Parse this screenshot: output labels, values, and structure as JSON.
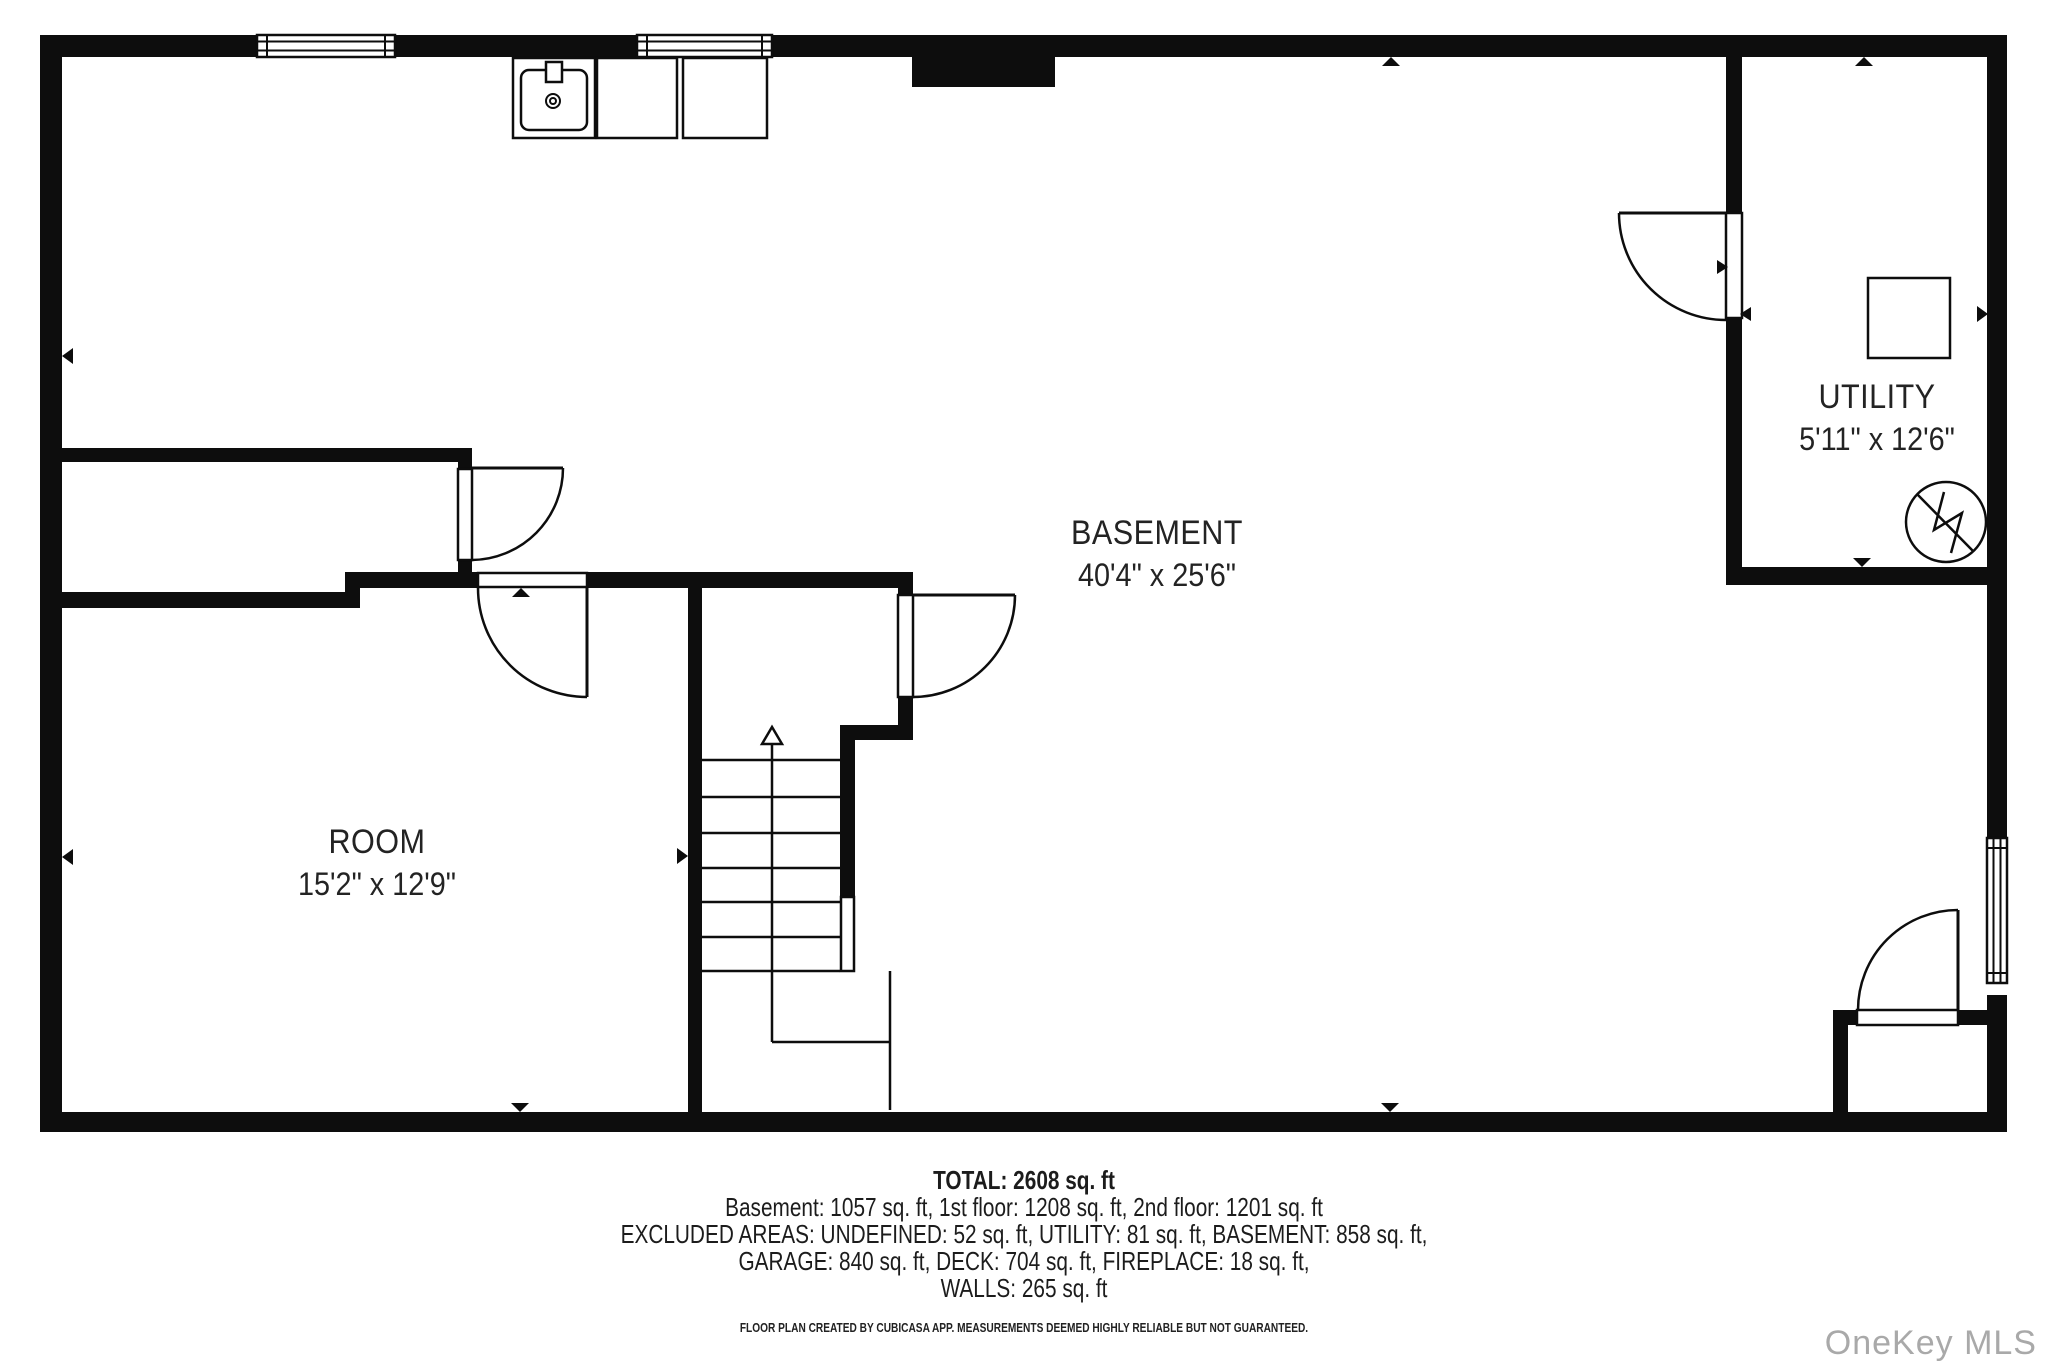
{
  "watermark": "OneKey MLS",
  "rooms": [
    {
      "name": "BASEMENT",
      "dims": "40'4\" x 25'6\"",
      "cx": 1157,
      "cy": 533
    },
    {
      "name": "UTILITY",
      "dims": "5'11\" x 12'6\"",
      "cx": 1877,
      "cy": 397
    },
    {
      "name": "ROOM",
      "dims": "15'2\" x 12'9\"",
      "cx": 377,
      "cy": 842
    }
  ],
  "footer": {
    "total": "TOTAL: 2608 sq. ft",
    "line1": "Basement: 1057 sq. ft, 1st floor: 1208 sq. ft, 2nd floor: 1201 sq. ft",
    "line2": "EXCLUDED AREAS: UNDEFINED: 52 sq. ft, UTILITY: 81 sq. ft, BASEMENT: 858 sq. ft,",
    "line3": "GARAGE: 840 sq. ft, DECK: 704 sq. ft, FIREPLACE: 18 sq. ft,",
    "line4": "WALLS: 265 sq. ft",
    "disclaimer": "FLOOR PLAN CREATED BY CUBICASA APP. MEASUREMENTS DEEMED HIGHLY RELIABLE BUT NOT GUARANTEED."
  },
  "plan": {
    "ink": "#0d0d0d",
    "walls": [
      [
        40,
        35,
        1967,
        22
      ],
      [
        40,
        35,
        22,
        1097
      ],
      [
        40,
        1112,
        1967,
        20
      ],
      [
        1987,
        35,
        20,
        803
      ],
      [
        1987,
        995,
        20,
        137
      ],
      [
        912,
        57,
        143,
        30
      ],
      [
        62,
        448,
        410,
        14
      ],
      [
        458,
        448,
        14,
        21
      ],
      [
        458,
        560,
        14,
        12
      ],
      [
        62,
        592,
        298,
        16
      ],
      [
        345,
        572,
        15,
        36
      ],
      [
        360,
        572,
        118,
        16
      ],
      [
        587,
        572,
        313,
        16
      ],
      [
        688,
        588,
        14,
        524
      ],
      [
        898,
        572,
        15,
        23
      ],
      [
        898,
        697,
        15,
        36
      ],
      [
        840,
        725,
        73,
        15
      ],
      [
        840,
        740,
        15,
        157
      ],
      [
        1726,
        57,
        16,
        156
      ],
      [
        1726,
        318,
        16,
        267
      ],
      [
        1726,
        567,
        281,
        18
      ],
      [
        1833,
        1010,
        15,
        102
      ],
      [
        1833,
        1010,
        24,
        15
      ],
      [
        1958,
        1010,
        29,
        15
      ]
    ],
    "openings": [
      [
        458,
        469,
        14,
        91
      ],
      [
        478,
        573,
        109,
        14
      ],
      [
        898,
        595,
        15,
        102
      ],
      [
        841,
        897,
        13,
        74
      ],
      [
        1726,
        213,
        16,
        105
      ],
      [
        1857,
        1010,
        101,
        15
      ]
    ],
    "door_leaves": [
      [
        472,
        468,
        563,
        468
      ],
      [
        587,
        588,
        587,
        697
      ],
      [
        913,
        595,
        1015,
        595
      ],
      [
        1619,
        213,
        1726,
        213
      ],
      [
        1958,
        910,
        1958,
        1010
      ]
    ],
    "door_arcs": [
      "M563,468 A92,92 0 0 1 472,560",
      "M478,588 A109,109 0 0 0 587,697",
      "M1015,595 A102,102 0 0 1 913,697",
      "M1619,213 A107,107 0 0 0 1726,320",
      "M1958,910 A100,100 0 0 0 1858,1010"
    ],
    "windows": [
      {
        "x": 257,
        "y": 35,
        "w": 138,
        "h": 22,
        "o": "h"
      },
      {
        "x": 637,
        "y": 35,
        "w": 135,
        "h": 22,
        "o": "h"
      },
      {
        "x": 1987,
        "y": 838,
        "w": 20,
        "h": 145,
        "o": "v"
      }
    ],
    "fixtures": [
      {
        "n": "sink-cabinet",
        "r": [
          513,
          58,
          82,
          80
        ]
      },
      {
        "n": "kitchen-appliance",
        "r": [
          597,
          58,
          80,
          80
        ]
      },
      {
        "n": "kitchen-appliance",
        "r": [
          683,
          58,
          84,
          80
        ]
      },
      {
        "n": "washer-box",
        "r": [
          1868,
          278,
          82,
          80
        ]
      }
    ],
    "sink": {
      "basin": [
        521,
        70,
        66,
        60
      ],
      "faucet": [
        546,
        62,
        16,
        20
      ],
      "drain_cx": 553,
      "drain_cy": 101,
      "r_outer": 7,
      "r_inner": 3
    },
    "water_heater": {
      "cx": 1946,
      "cy": 522,
      "r": 40,
      "diag": [
        1917,
        494,
        1973,
        551
      ],
      "zig": "1944,492 1934,530 1962,513 1951,553"
    },
    "stairs": {
      "tread_x1": 702,
      "tread_x2": 840,
      "treads": [
        760,
        797,
        833,
        868,
        902,
        937,
        971
      ],
      "center_line": [
        772,
        744,
        772,
        971
      ],
      "arrow": "772,727 762,744 782,744",
      "under_lines": [
        [
          772,
          971,
          772,
          1042
        ],
        [
          772,
          1042,
          891,
          1042
        ],
        [
          890,
          971,
          890,
          1110
        ]
      ]
    },
    "markers": [
      "62,356 73,348 73,364",
      "62,857 73,849 73,865",
      "1391,57 1382,66 1400,66",
      "1864,57 1855,66 1873,66",
      "1988,314 1977,306 1977,322",
      "1862,567 1853,558 1871,558",
      "1728,267 1717,260 1717,274",
      "1740,314 1751,307 1751,321",
      "688,856 677,848 677,864",
      "521,588 512,597 530,597",
      "520,1112 511,1103 529,1103",
      "1390,1112 1381,1103 1399,1103"
    ]
  }
}
